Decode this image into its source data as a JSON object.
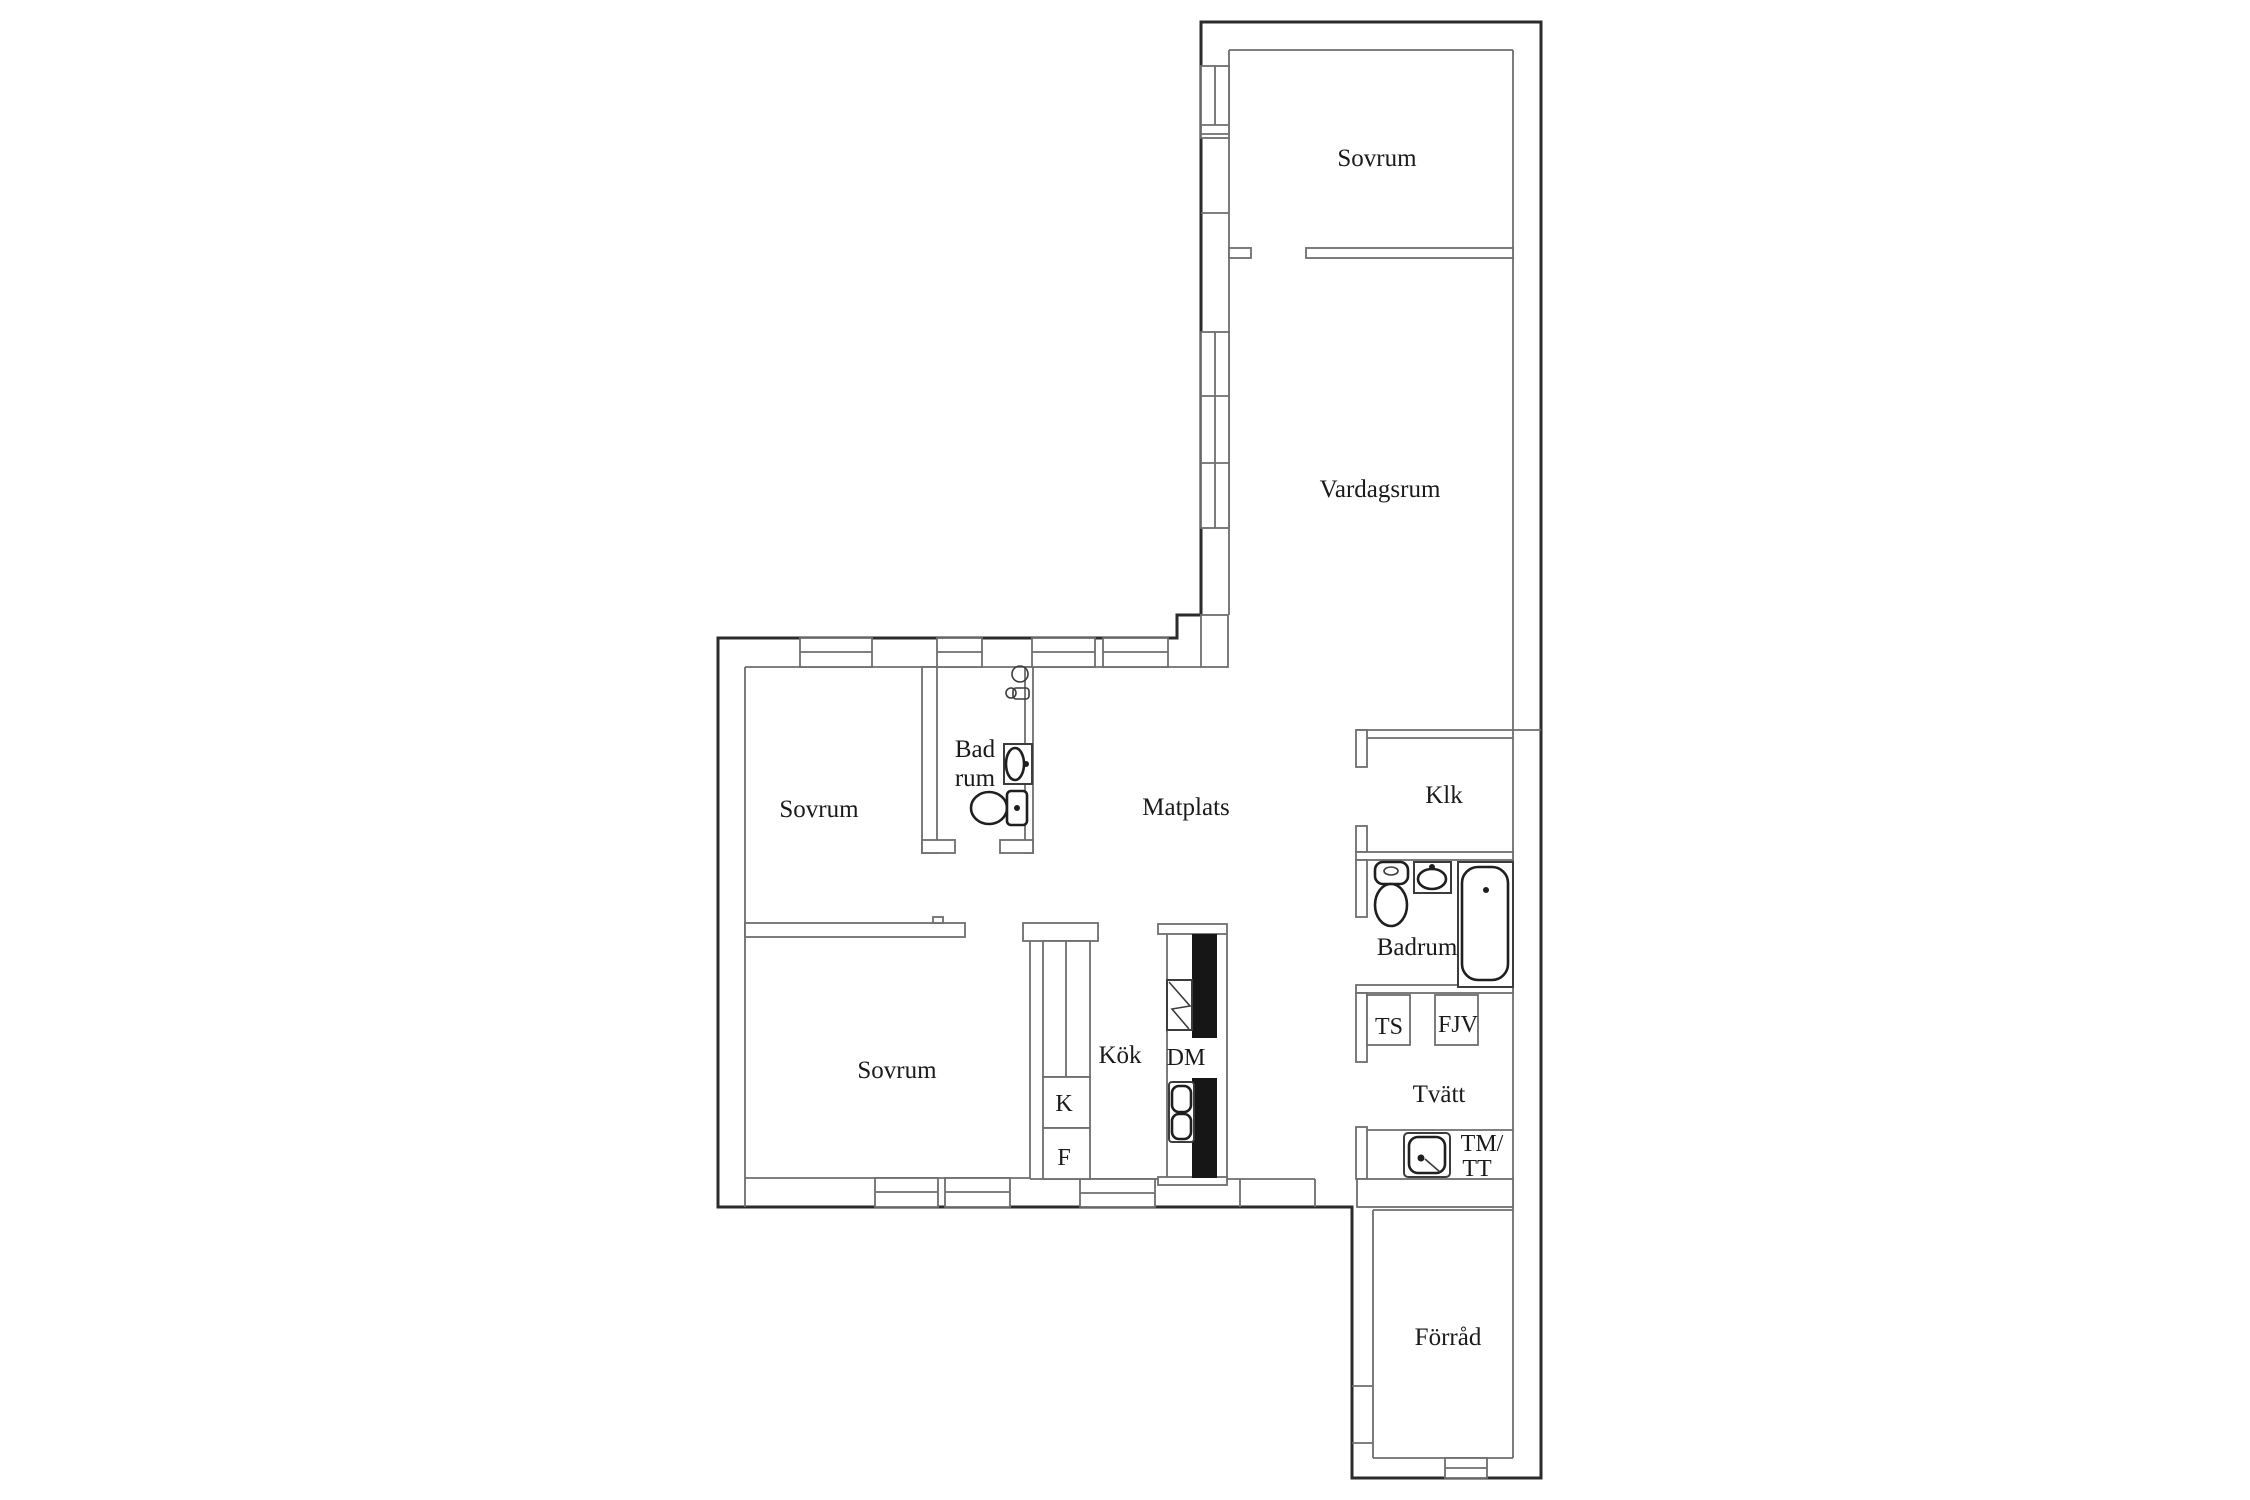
{
  "floorplan": {
    "labels": {
      "sovrum_top": "Sovrum",
      "vardagsrum": "Vardagsrum",
      "klk": "Klk",
      "badrum": "Badrum",
      "ts": "TS",
      "fjv": "FJV",
      "tvatt": "Tvätt",
      "tm": "TM/",
      "tt": "TT",
      "forrad": "Förråd",
      "sovrum_mid": "Sovrum",
      "bad_line1": "Bad",
      "bad_line2": "rum",
      "matplats": "Matplats",
      "sovrum_bottom": "Sovrum",
      "kok": "Kök",
      "dm": "DM",
      "k": "K",
      "f": "F"
    },
    "colors": {
      "outer_wall": "#2b2b2b",
      "inner_wall": "#6e6e6e",
      "text": "#1a1a1a",
      "tub_fill": "#f1f1f1",
      "counter_bar": "#161616",
      "background": "#ffffff"
    },
    "icons": [
      "window-icon",
      "toilet-icon",
      "sink-icon",
      "bathtub-icon",
      "floor-drain-icon",
      "wall-faucet-icon",
      "stove-icon",
      "kitchen-sink-icon",
      "laundry-sink-icon"
    ]
  }
}
